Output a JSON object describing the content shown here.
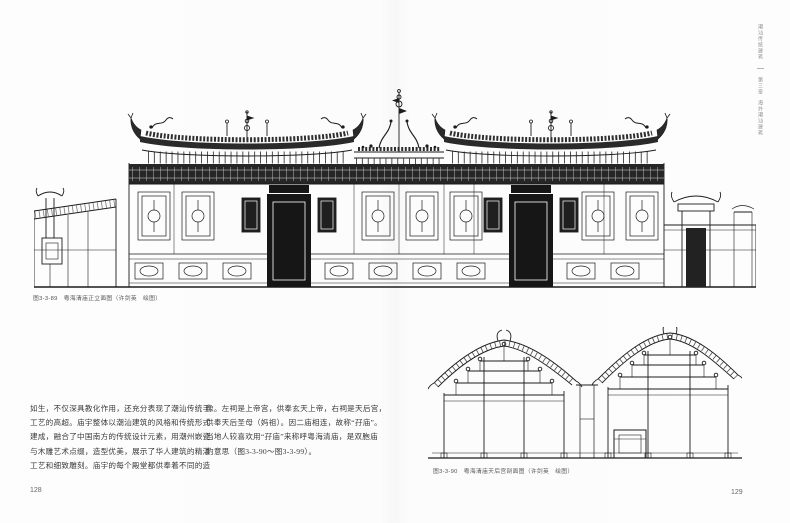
{
  "page_numbers": {
    "left": "128",
    "right": "129"
  },
  "running_head": {
    "book_title": "潮汕传统建筑",
    "chapter": "第三章",
    "section": "海外潮汕建筑"
  },
  "figures": {
    "elevation": {
      "caption": "图3-3-89　粤海清庙正立面图（许剑英　绘图）"
    },
    "section": {
      "caption": "图3-3-90　粤海清庙天后宫剖面图（许剑英　绘图）"
    }
  },
  "body": {
    "column1": [
      "如生，不仅深具教化作用，还充分表现了潮汕传统手",
      "工艺的高超。庙宇整体以潮汕建筑的风格和传统形式",
      "建成，融合了中国南方的传统设计元素，用潮州嵌瓷",
      "与木雕艺术点缀，造型优美，展示了华人建筑的精湛",
      "工艺和细致雕刻。庙宇的每个殿堂都供奉着不同的造"
    ],
    "column2": [
      "像。左祠是上帝宫，供奉玄天上帝，右祠是天后宫，",
      "供奉天后圣母（妈祖）。因二庙相连，故称“孖庙”。",
      "当地人较喜欢用“孖庙”来称呼粤海清庙，是双胞庙",
      "的意思（图3-3-90～图3-3-99）。"
    ]
  }
}
